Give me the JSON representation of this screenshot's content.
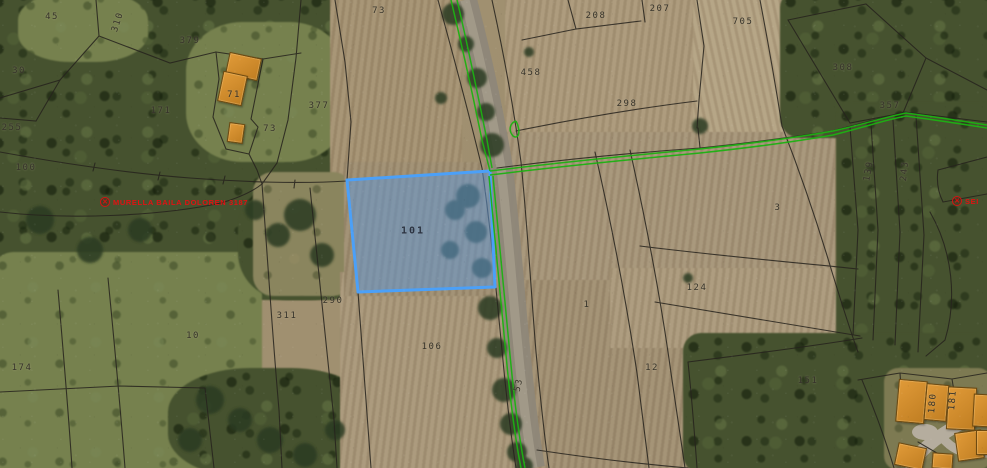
{
  "map": {
    "title": "Cadastral parcel viewer over aerial orthophoto",
    "selected_parcel": {
      "number": "101",
      "x": 413,
      "y": 231
    },
    "parcel_labels": [
      {
        "text": "45",
        "x": 52,
        "y": 17
      },
      {
        "text": "310",
        "x": 118,
        "y": 22,
        "rot": -72
      },
      {
        "text": "379",
        "x": 190,
        "y": 41
      },
      {
        "text": "30",
        "x": 19,
        "y": 71
      },
      {
        "text": "171",
        "x": 161,
        "y": 111
      },
      {
        "text": "377",
        "x": 319,
        "y": 106
      },
      {
        "text": "73",
        "x": 270,
        "y": 129
      },
      {
        "text": "71",
        "x": 234,
        "y": 95
      },
      {
        "text": "255",
        "x": 12,
        "y": 128
      },
      {
        "text": "100",
        "x": 26,
        "y": 168
      },
      {
        "text": "73",
        "x": 379,
        "y": 11
      },
      {
        "text": "208",
        "x": 596,
        "y": 16
      },
      {
        "text": "207",
        "x": 660,
        "y": 9
      },
      {
        "text": "705",
        "x": 743,
        "y": 22
      },
      {
        "text": "458",
        "x": 531,
        "y": 73
      },
      {
        "text": "298",
        "x": 627,
        "y": 104
      },
      {
        "text": "308",
        "x": 843,
        "y": 68
      },
      {
        "text": "357",
        "x": 890,
        "y": 106
      },
      {
        "text": "139",
        "x": 869,
        "y": 171,
        "rot": -80
      },
      {
        "text": "243",
        "x": 905,
        "y": 171,
        "rot": -84
      },
      {
        "text": "3",
        "x": 778,
        "y": 208
      },
      {
        "text": "290",
        "x": 333,
        "y": 301
      },
      {
        "text": "311",
        "x": 287,
        "y": 316
      },
      {
        "text": "106",
        "x": 432,
        "y": 347
      },
      {
        "text": "1",
        "x": 587,
        "y": 305
      },
      {
        "text": "124",
        "x": 697,
        "y": 288
      },
      {
        "text": "12",
        "x": 652,
        "y": 368
      },
      {
        "text": "151",
        "x": 808,
        "y": 381
      },
      {
        "text": "174",
        "x": 22,
        "y": 368
      },
      {
        "text": "10",
        "x": 193,
        "y": 336
      },
      {
        "text": "53",
        "x": 519,
        "y": 385,
        "rot": -78
      },
      {
        "text": "180",
        "x": 933,
        "y": 403,
        "rot": -85
      },
      {
        "text": "181",
        "x": 953,
        "y": 400,
        "rot": -85
      }
    ],
    "poi_labels": {
      "left": {
        "marker": "✕",
        "text": "MURELLA BAILA DOLOREN 3187"
      },
      "right": {
        "marker": "✕",
        "text": "SEI"
      }
    },
    "colors": {
      "selection_fill": "#6098d6",
      "selection_border": "#4ba0f8",
      "trail_green": "#1cb212",
      "boundary_black": "#26231d",
      "building_orange": "#d28a2c",
      "marker_red": "#d81111"
    }
  }
}
